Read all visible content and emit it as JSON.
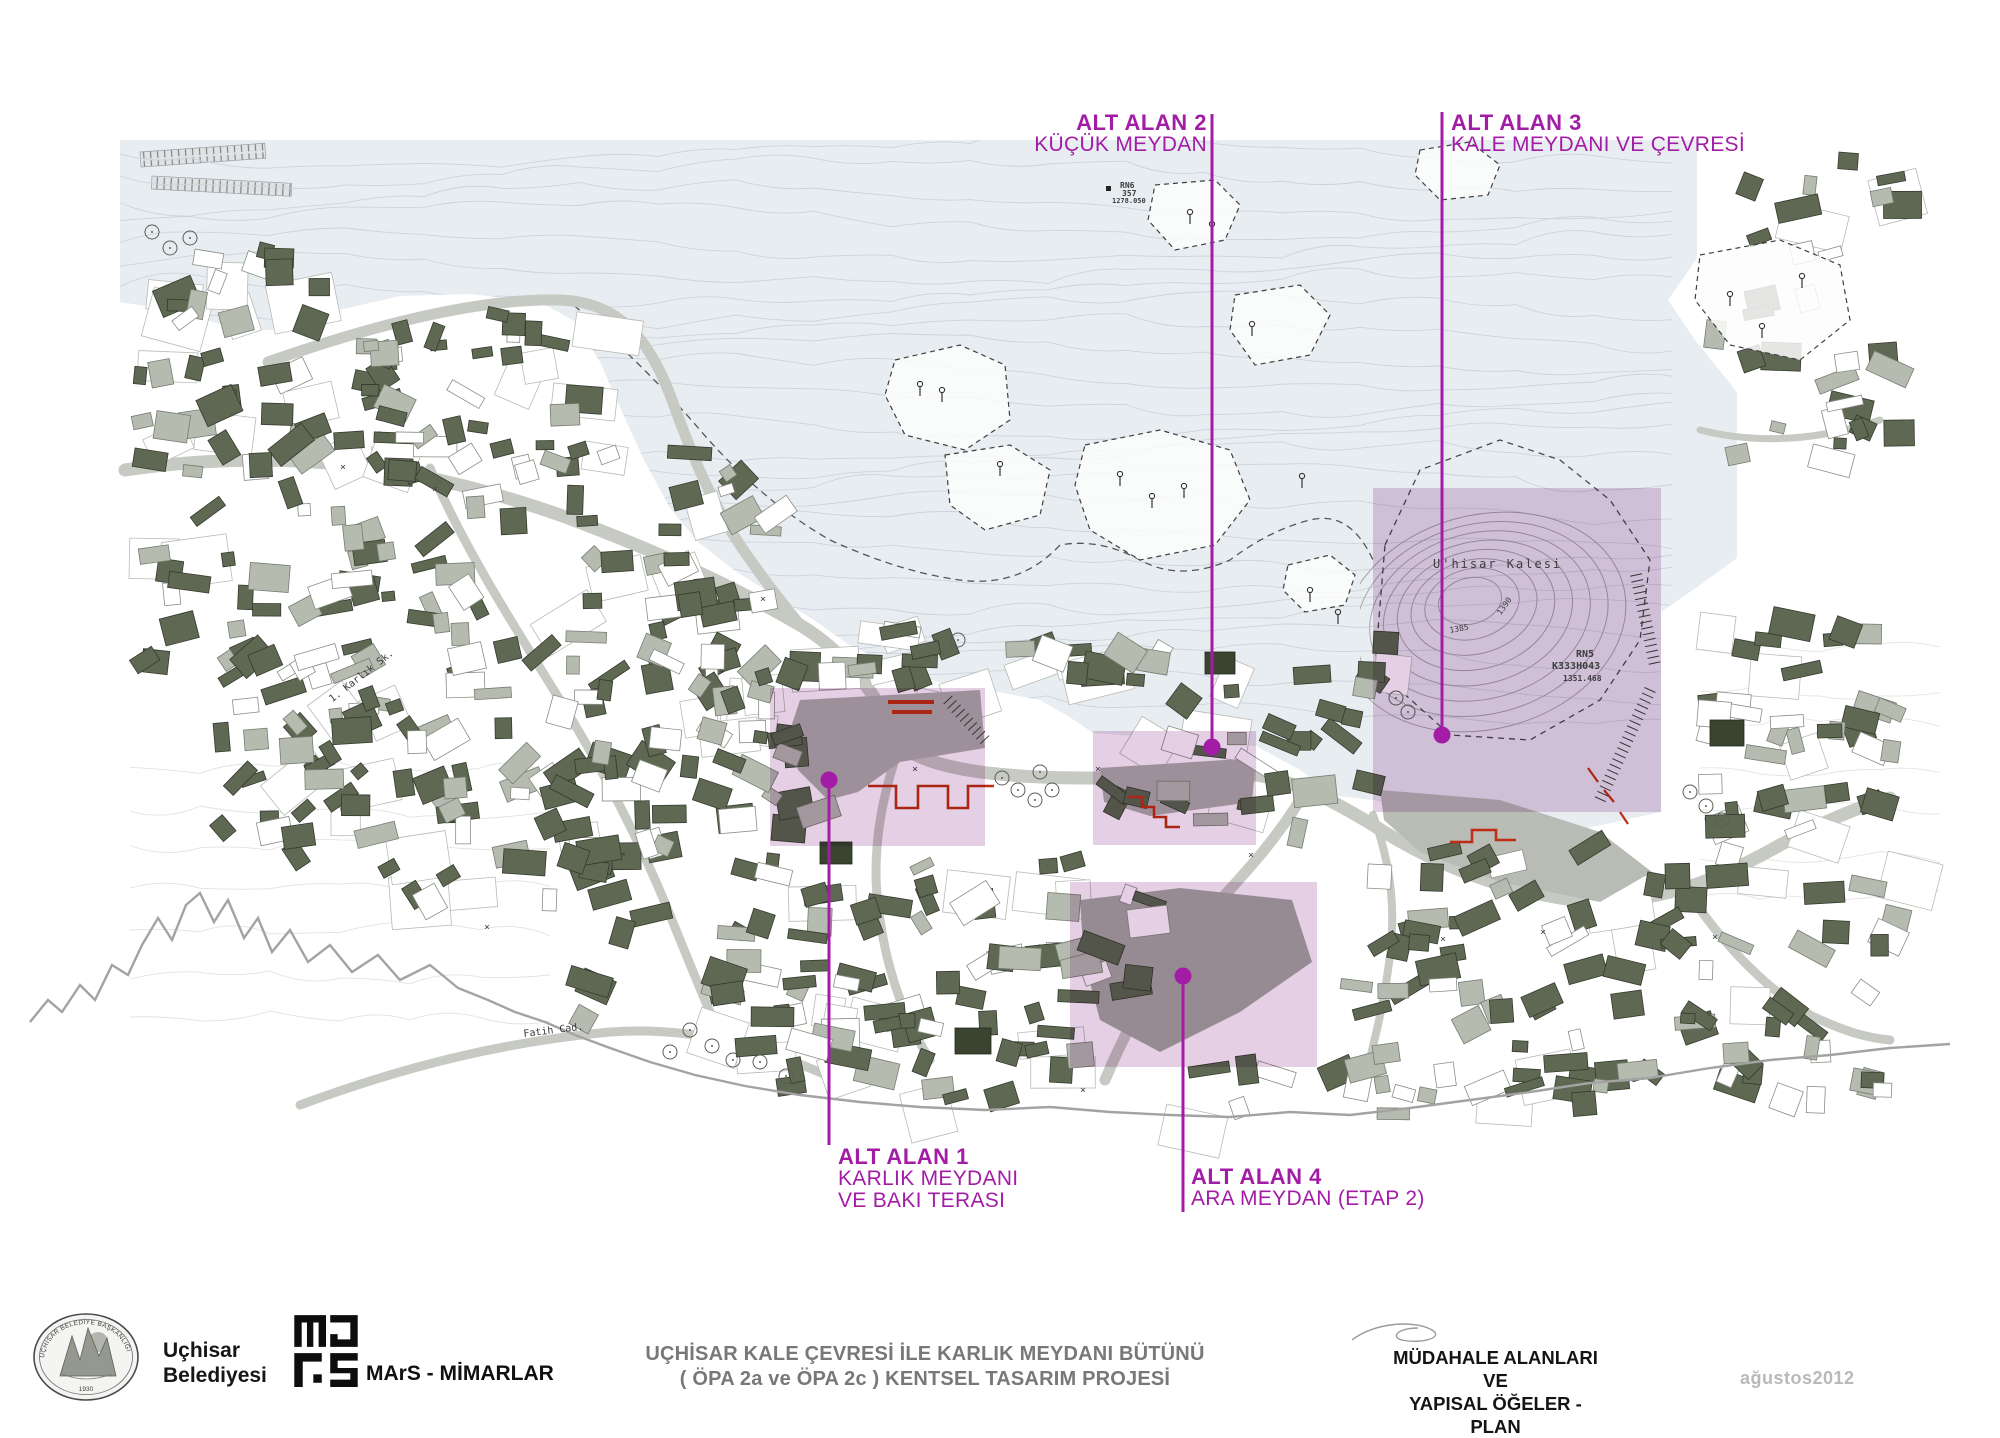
{
  "sheet": {
    "background": "#ffffff",
    "accent_magenta": "#a31ca6"
  },
  "map": {
    "colors": {
      "highland_tint": "#e8edf2",
      "contour_line": "#ccd3db",
      "road_gray": "#c7c9c3",
      "building_dark": "#5e6852",
      "building_light": "#b6bbb0",
      "overlay_purple": "#c99fc9",
      "red_element": "#bf2d15",
      "terrain_profile_line": "#a3a3a3"
    },
    "areas": [
      {
        "title": "ALT ALAN 1",
        "lines": [
          "KARLIK MEYDANI",
          "VE BAKI TERASI"
        ],
        "rect": [
          770,
          688,
          215,
          158
        ],
        "leader": {
          "x": 829,
          "dot_y": 780,
          "end_y": 1145
        },
        "label": {
          "x": 838,
          "y": 1146,
          "align": "left"
        }
      },
      {
        "title": "ALT ALAN 2",
        "lines": [
          "KÜÇÜK MEYDAN"
        ],
        "rect": [
          1093,
          731,
          163,
          114
        ],
        "leader": {
          "x": 1212,
          "dot_y": 747,
          "end_y": 114
        },
        "label": {
          "x": 1207,
          "y": 112,
          "align": "right"
        }
      },
      {
        "title": "ALT ALAN 3",
        "lines": [
          "KALE MEYDANI VE ÇEVRESİ"
        ],
        "rect": [
          1373,
          488,
          288,
          324
        ],
        "leader": {
          "x": 1442,
          "dot_y": 735,
          "end_y": 112
        },
        "label": {
          "x": 1451,
          "y": 112,
          "align": "left"
        }
      },
      {
        "title": "ALT ALAN 4",
        "lines": [
          "ARA MEYDAN  (ETAP 2)"
        ],
        "rect": [
          1070,
          882,
          247,
          185
        ],
        "leader": {
          "x": 1183,
          "dot_y": 976,
          "end_y": 1212
        },
        "label": {
          "x": 1191,
          "y": 1166,
          "align": "left"
        }
      }
    ],
    "annotations": [
      {
        "text": "U'hisar Kalesi",
        "x": 1433,
        "y": 558,
        "size": 12,
        "rot": 0,
        "bold": false,
        "spacing": 2
      },
      {
        "text": "1385",
        "x": 1449,
        "y": 627,
        "size": 8,
        "rot": -10
      },
      {
        "text": "1390",
        "x": 1496,
        "y": 612,
        "size": 8,
        "rot": -55
      },
      {
        "text": "RN5",
        "x": 1576,
        "y": 650,
        "size": 10,
        "bold": true
      },
      {
        "text": "K333H043",
        "x": 1552,
        "y": 662,
        "size": 10,
        "bold": true
      },
      {
        "text": "1351.468",
        "x": 1563,
        "y": 675,
        "size": 8,
        "bold": true
      },
      {
        "text": "RN6",
        "x": 1120,
        "y": 182,
        "size": 8,
        "bold": true
      },
      {
        "text": "357",
        "x": 1122,
        "y": 190,
        "size": 8,
        "bold": true
      },
      {
        "text": "1278.050",
        "x": 1112,
        "y": 198,
        "size": 7,
        "bold": true
      },
      {
        "text": "1. Karlık Sk.",
        "x": 328,
        "y": 697,
        "size": 10,
        "rot": -38
      },
      {
        "text": "Fatih Cad.",
        "x": 523,
        "y": 1030,
        "size": 10,
        "rot": -7
      }
    ]
  },
  "footer": {
    "municipality_name": [
      "Uçhisar",
      "Belediyesi"
    ],
    "seal": {
      "ring_text": "UÇHİSAR BELEDİYE BAŞKANLIĞI",
      "year": "1930"
    },
    "architect_label": "MArS - MİMARLAR",
    "project_title": [
      "UÇHİSAR KALE ÇEVRESİ İLE KARLIK MEYDANI BÜTÜNÜ",
      "( ÖPA 2a ve ÖPA 2c ) KENTSEL TASARIM PROJESİ"
    ],
    "sheet_title": [
      "MÜDAHALE ALANLARI VE",
      "YAPISAL ÖĞELER - PLAN"
    ],
    "date": "ağustos2012"
  }
}
